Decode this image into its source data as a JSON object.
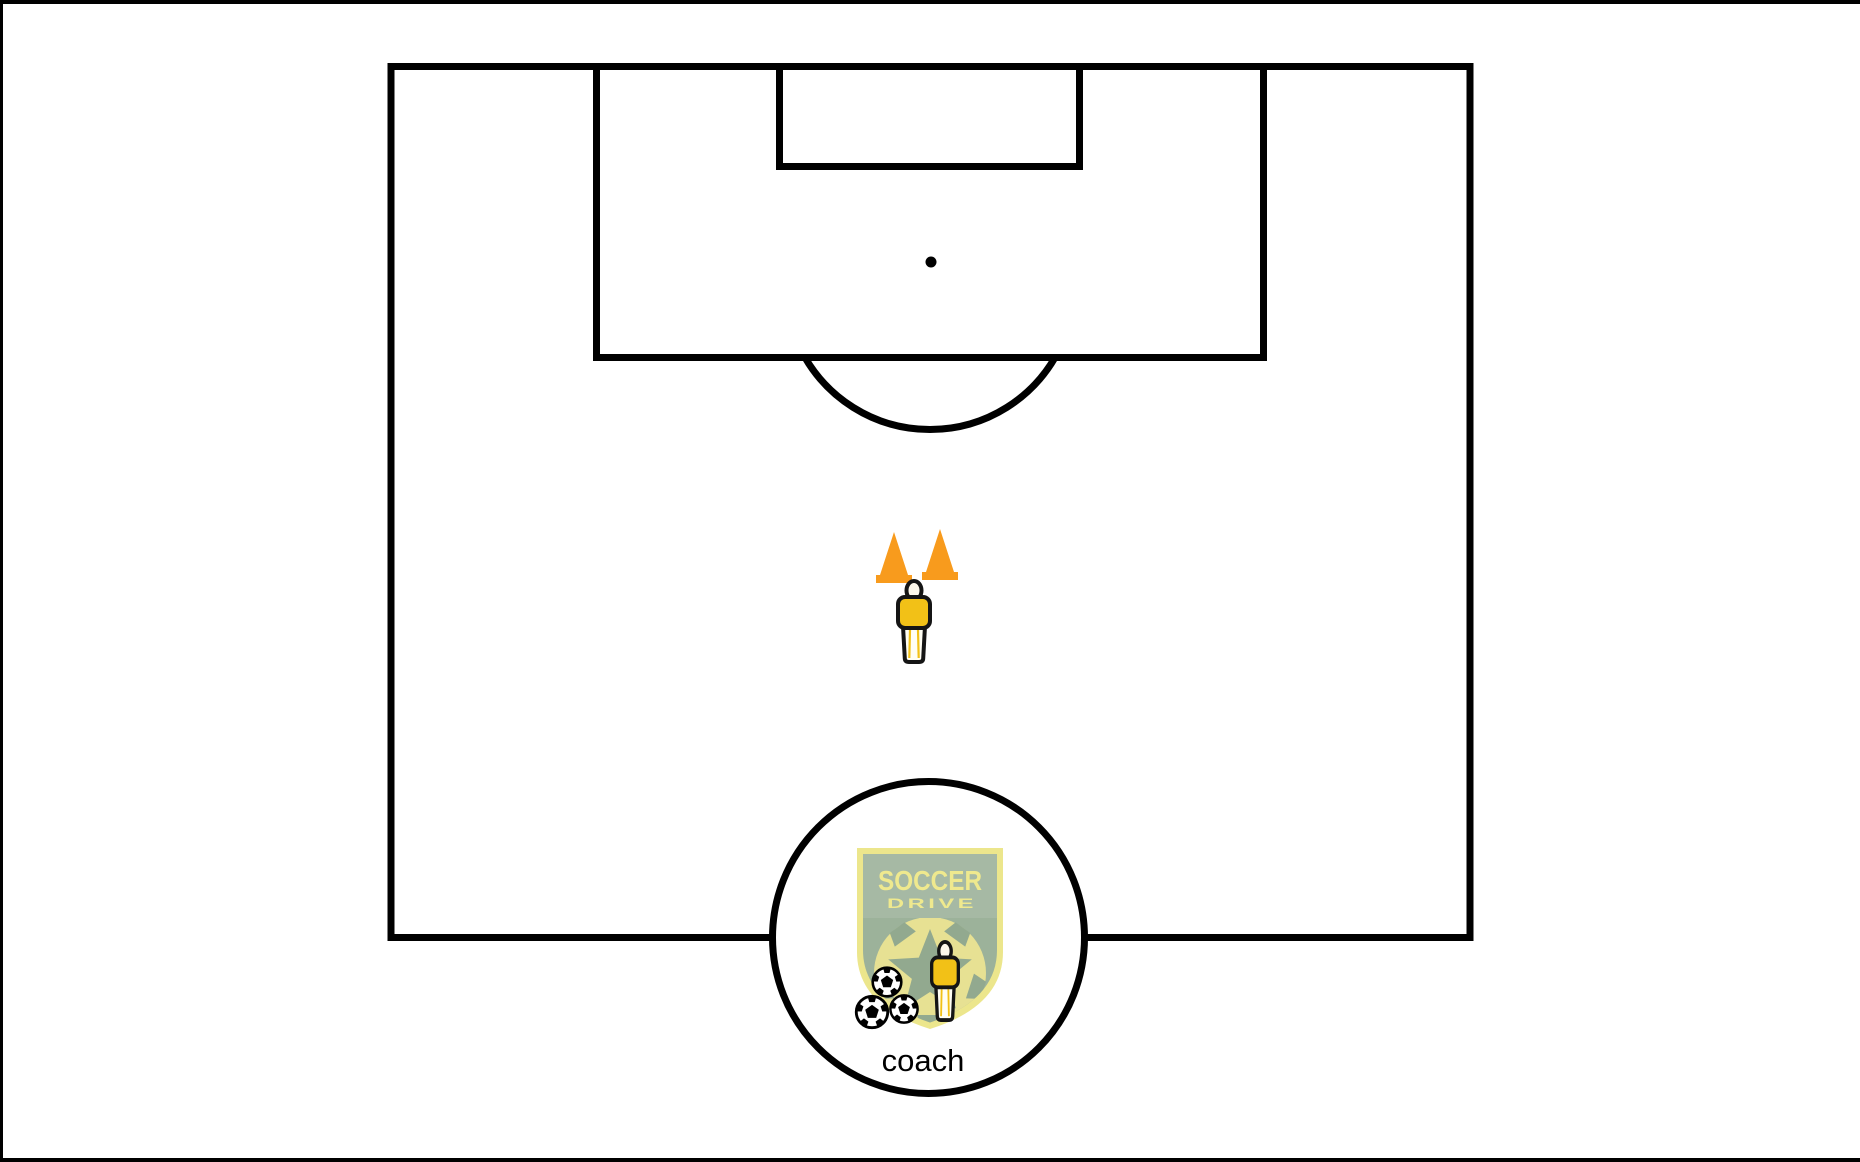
{
  "canvas": {
    "background": "#ffffff",
    "frame_color": "#000000"
  },
  "field": {
    "line_color": "#000000"
  },
  "pieces": {
    "cone_color": "#F89B1D",
    "player": {
      "shirt_color": "#F2C117",
      "legs_color": "#FFFEF4",
      "head_color": "#FDF8EB"
    }
  },
  "coach_marker": {
    "label": "coach",
    "label_color": "#000000",
    "logo": {
      "title": "SOCCER",
      "subtitle": "DRIVE",
      "text_color": "#EFE98E",
      "shield_color": "#ECE68C",
      "band_color": "#A6B9A4",
      "interior_color": "#9CB29A",
      "ball_color": "#E7E193",
      "pattern_color": "#92A98F"
    }
  }
}
